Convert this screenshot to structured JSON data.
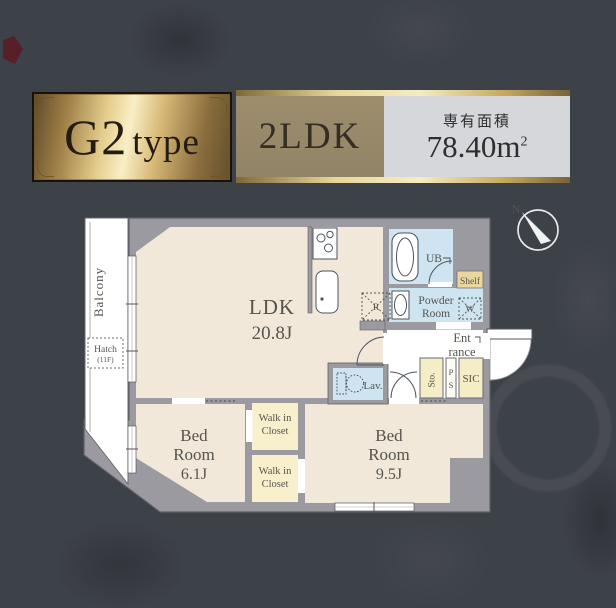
{
  "header": {
    "type_name": "G2",
    "type_word": "type",
    "layout": "2LDK",
    "area_label": "専有面積",
    "area_value": "78.40",
    "area_unit": "m",
    "area_exp": "2"
  },
  "plan": {
    "compass_n": "N",
    "balcony_label": "Balcony",
    "hatch_line1": "Hatch",
    "hatch_line2": "(11F)",
    "ldk_name": "LDK",
    "ldk_size": "20.8J",
    "bedroom1_line1": "Bed",
    "bedroom1_line2": "Room",
    "bedroom1_size": "6.1J",
    "bedroom2_line1": "Bed",
    "bedroom2_line2": "Room",
    "bedroom2_size": "9.5J",
    "wic_line1": "Walk in",
    "wic_line2": "Closet",
    "ub_label": "UB",
    "powder_line1": "Powder",
    "powder_line2": "Room",
    "shelf_label": "Shelf",
    "entrance_line1": "Ent",
    "entrance_line2": "rance",
    "sto_label": "Sto.",
    "ps_letter1": "P",
    "ps_letter2": "S",
    "sic_label": "SIC",
    "lav_label": "Lav.",
    "fridge_label": "R",
    "washer_label": "W"
  },
  "colors": {
    "background": "#3d4148",
    "wall": "#9b9aa1",
    "floor_beige": "#f2e8d9",
    "room_blue": "#cfe4f1",
    "closet_cream": "#f8f0cd",
    "shelf_tan": "#ead7a0",
    "gold_light": "#f4e6b4",
    "gold_dark": "#8a6f3e",
    "bronze_plate": "#9c8d6d",
    "area_plate": "#d5d7da"
  }
}
